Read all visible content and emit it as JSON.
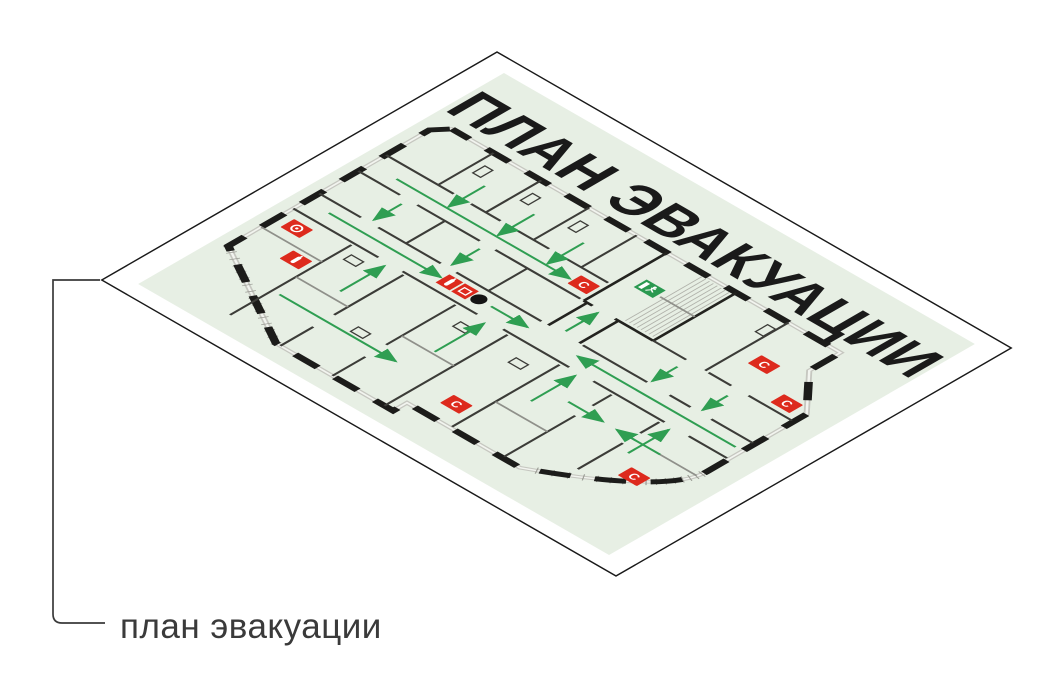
{
  "board": {
    "title": "ПЛАН ЭВАКУАЦИИ",
    "title_color": "#1d1d1b",
    "face_color": "#ffffff",
    "outline_color": "#1a1a1a",
    "plan_bg_color": "#e7efe4"
  },
  "callout": {
    "label": "план эвакуации",
    "line_color": "#3a3a3a"
  },
  "plan": {
    "colors": {
      "wall": "#1c1c1a",
      "arrow_green": "#2f9e52",
      "icon_red": "#dd2a1d",
      "exit_green": "#2a9950",
      "dot_black": "#141414"
    },
    "you_are_here": {
      "x": 238,
      "y": 259
    },
    "exit_icon": {
      "name": "emergency-exit-icon",
      "x": 326,
      "y": 150
    },
    "icons": [
      {
        "name": "fire-alarm-button-icon",
        "glyph": "ring",
        "x": 62,
        "y": 293
      },
      {
        "name": "fire-extinguisher-icon",
        "glyph": "bar",
        "x": 93,
        "y": 325
      },
      {
        "name": "fire-station-icon",
        "glyph": "double",
        "x": 213,
        "y": 259
      },
      {
        "name": "fire-hose-icon",
        "glyph": "C",
        "char": "С",
        "x": 284,
        "y": 184
      },
      {
        "name": "fire-hose-icon",
        "glyph": "C",
        "char": "С",
        "x": 468,
        "y": 160
      },
      {
        "name": "fire-hose-icon",
        "glyph": "C",
        "char": "С",
        "x": 520,
        "y": 186
      },
      {
        "name": "fire-hose-icon",
        "glyph": "C",
        "char": "С",
        "x": 505,
        "y": 347
      },
      {
        "name": "fire-hose-icon",
        "glyph": "C",
        "char": "С",
        "x": 330,
        "y": 377
      }
    ],
    "arrows": [
      [
        65,
        259,
        194,
        259
      ],
      [
        252,
        259,
        294,
        259
      ],
      [
        534,
        259,
        352,
        259
      ],
      [
        320,
        241,
        320,
        204
      ],
      [
        128,
        142,
        128,
        184
      ],
      [
        185,
        142,
        185,
        184
      ],
      [
        242,
        142,
        242,
        184
      ],
      [
        70,
        186,
        270,
        186
      ],
      [
        98,
        208,
        98,
        240
      ],
      [
        188,
        208,
        188,
        240
      ],
      [
        420,
        212,
        420,
        241
      ],
      [
        478,
        212,
        478,
        241
      ],
      [
        150,
        331,
        150,
        280
      ],
      [
        265,
        337,
        265,
        280
      ],
      [
        370,
        331,
        370,
        280
      ],
      [
        478,
        327,
        478,
        280
      ],
      [
        118,
        369,
        252,
        369
      ],
      [
        392,
        310,
        432,
        310
      ],
      [
        498,
        310,
        448,
        310
      ]
    ]
  }
}
